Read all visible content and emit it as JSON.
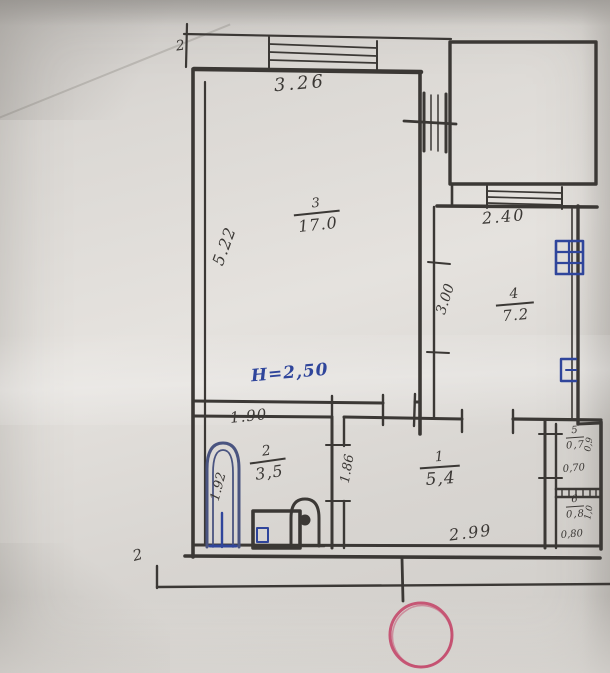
{
  "plan": {
    "markers": {
      "top": "2",
      "bottom": "2"
    },
    "dims": {
      "top_width": "3.26",
      "left_height": "5.22",
      "ceiling": "H=2,50",
      "kitchen_top": "2.40",
      "kitchen_left": "3.00",
      "bath_top": "1.90",
      "bath_tub": "1.92",
      "hall_left": "1.86",
      "hall_bottom": "2.99",
      "closet5_width": "0,70",
      "closet5_depth": "0,9",
      "closet6_width": "0,80",
      "closet6_depth": "1,0"
    },
    "rooms": {
      "r3": {
        "number": "3",
        "area": "17.0"
      },
      "r4": {
        "number": "4",
        "area": "7.2"
      },
      "r2": {
        "number": "2",
        "area": "3,5"
      },
      "r1": {
        "number": "1",
        "area": "5,4"
      },
      "r5": {
        "number": "5",
        "area": "0,7"
      },
      "r6": {
        "number": "6",
        "area": "0,8"
      }
    },
    "symbols": {
      "bathtub": "bathtub",
      "sink": "sink",
      "toilet": "toilet",
      "window_stamp": "blue window stamp",
      "radiator": "blue radiator mark",
      "annotation": "red circle"
    },
    "colors": {
      "ink": "#3b3835",
      "blue": "#2f459b",
      "red": "#c4496b",
      "paper": "#d9d6d2"
    }
  }
}
